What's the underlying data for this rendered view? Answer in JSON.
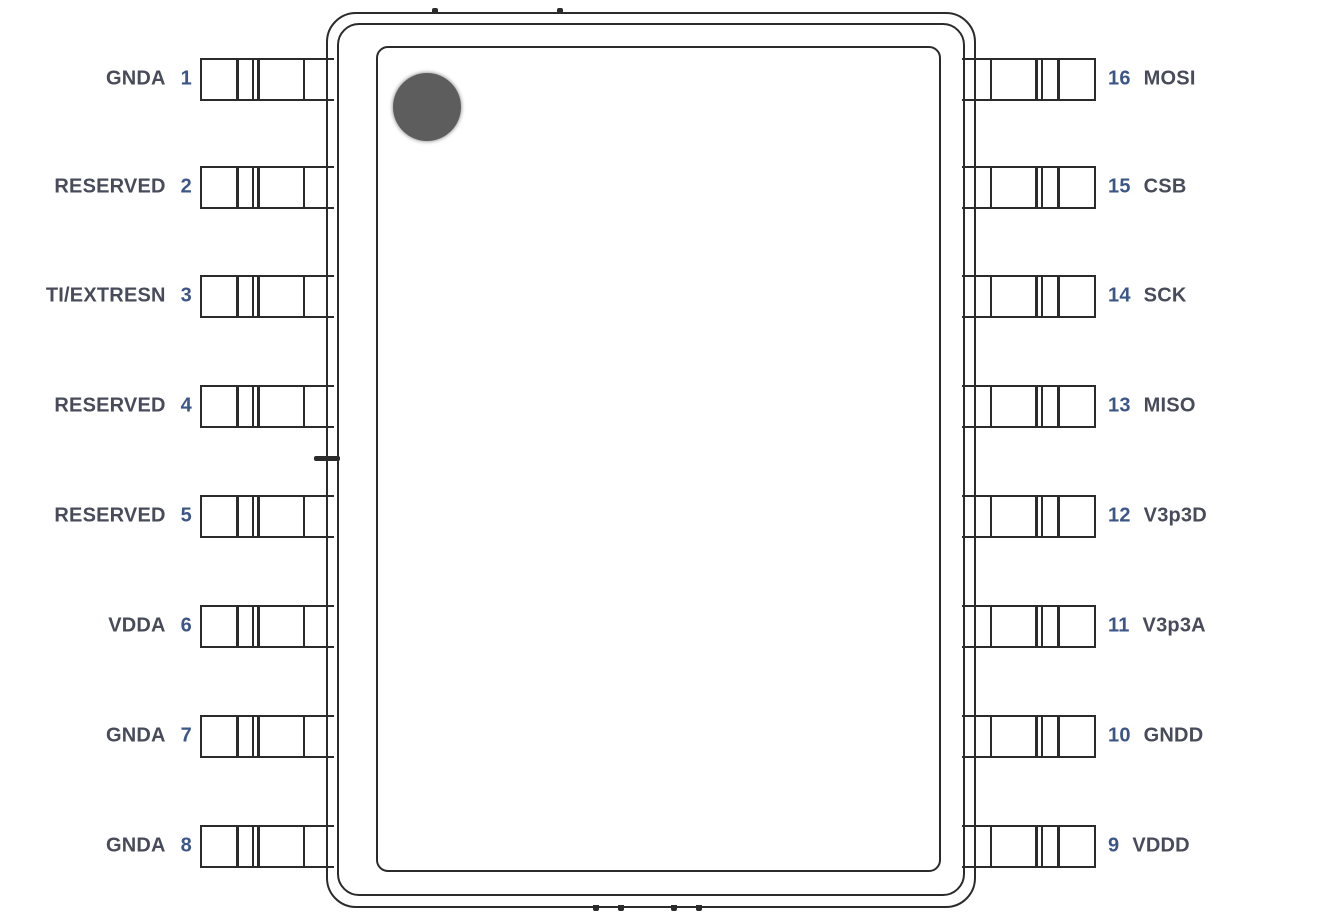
{
  "diagram": {
    "kind": "ic-pinout-top-view",
    "package": "16-pin dual-row (SOIC-style)",
    "pin1_marker": "gray-dot-top-left"
  },
  "pins": {
    "left": [
      {
        "number": "1",
        "name": "GNDA"
      },
      {
        "number": "2",
        "name": "RESERVED"
      },
      {
        "number": "3",
        "name": "TI/EXTRESN"
      },
      {
        "number": "4",
        "name": "RESERVED"
      },
      {
        "number": "5",
        "name": "RESERVED"
      },
      {
        "number": "6",
        "name": "VDDA"
      },
      {
        "number": "7",
        "name": "GNDA"
      },
      {
        "number": "8",
        "name": "GNDA"
      }
    ],
    "right": [
      {
        "number": "16",
        "name": "MOSI"
      },
      {
        "number": "15",
        "name": "CSB"
      },
      {
        "number": "14",
        "name": "SCK"
      },
      {
        "number": "13",
        "name": "MISO"
      },
      {
        "number": "12",
        "name": "V3p3D"
      },
      {
        "number": "11",
        "name": "V3p3A"
      },
      {
        "number": "10",
        "name": "GNDD"
      },
      {
        "number": "9",
        "name": "VDDD"
      }
    ]
  },
  "colors": {
    "background": "#ffffff",
    "line": "#2b2b2b",
    "pin_name_text": "#474b5a",
    "pin_number_text": "#3b5687",
    "pin1_dot": "#5d5d5d"
  }
}
